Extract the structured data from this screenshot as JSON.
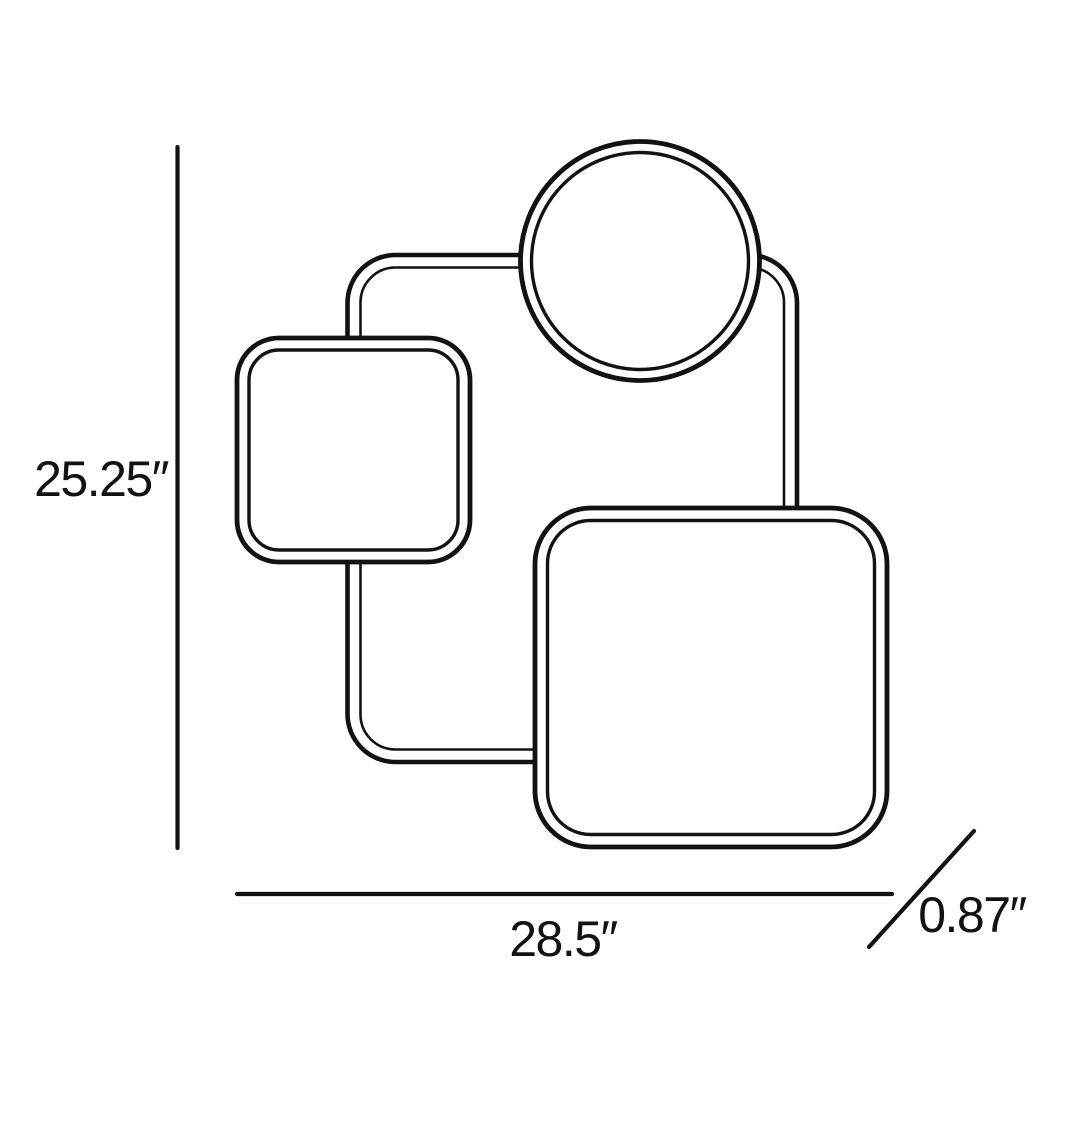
{
  "diagram": {
    "kind": "product-dimension-line-drawing",
    "colors": {
      "ink": "#121212",
      "background": "#ffffff"
    },
    "dimensions": {
      "height_label": "25.25″",
      "width_label": "28.5″",
      "depth_label": "0.87″"
    },
    "shapes": [
      "connector-frame",
      "circle-panel",
      "small-rounded-square-panel",
      "large-rounded-square-panel"
    ]
  }
}
